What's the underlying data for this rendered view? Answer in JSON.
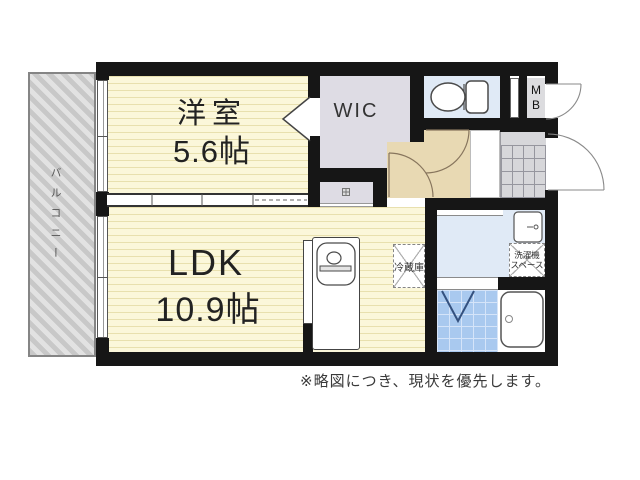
{
  "floorplan": {
    "western_room": {
      "name": "洋室",
      "size": "5.6帖"
    },
    "ldk": {
      "name": "LDK",
      "size": "10.9帖"
    },
    "wic": {
      "label": "WIC"
    },
    "balcony": {
      "label": "バルコニー"
    },
    "meter_box": {
      "m": "M",
      "b": "B"
    },
    "refrigerator": {
      "label": "冷蔵庫"
    },
    "washer_space": {
      "line1": "洗濯機",
      "line2": "スペース"
    },
    "caption": "※略図につき、現状を優先します。",
    "colors": {
      "wall": "#161616",
      "room_floor": "#fbf7da",
      "hallway_floor": "#e8d9b3",
      "wic_floor": "#dedce4",
      "wet_area_floor": "#e0eaf6",
      "bath_tile": "#a9c9ef",
      "balcony": "#d9d9d9",
      "entrance_tile": "#d7d7da"
    }
  }
}
